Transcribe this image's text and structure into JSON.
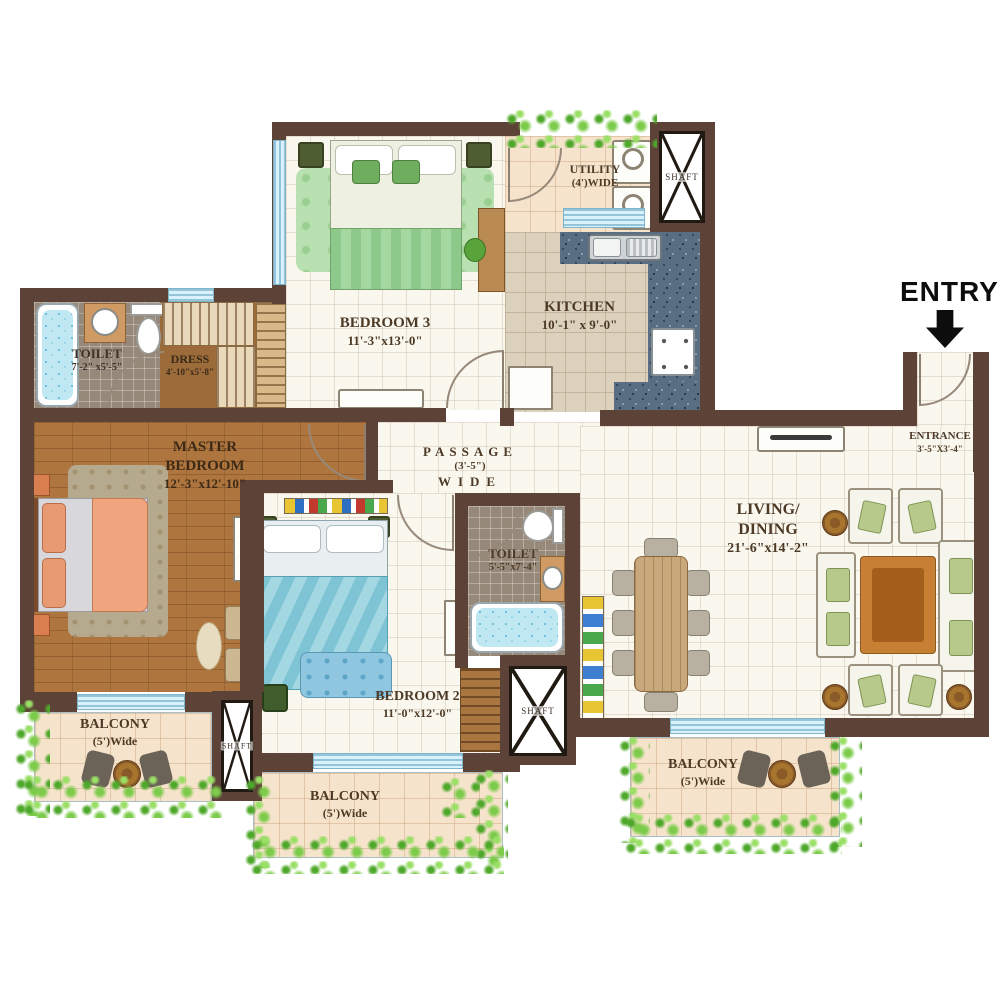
{
  "entry": {
    "label": "ENTRY"
  },
  "rooms": {
    "bedroom3": {
      "name": "BEDROOM 3",
      "dims": "11'-3\"x13'-0\""
    },
    "utility": {
      "name": "UTILITY",
      "dims": "(4')WIDE"
    },
    "kitchen": {
      "name": "KITCHEN",
      "dims": "10'-1\" x 9'-0\""
    },
    "toilet1": {
      "name": "TOILET",
      "dims": "7'-2\" x5'-5\""
    },
    "dress": {
      "name": "DRESS",
      "dims": "4'-10\"x5'-8\""
    },
    "master_bedroom": {
      "line1": "MASTER",
      "line2": "BEDROOM",
      "dims": "12'-3\"x12'-10\""
    },
    "passage": {
      "name": "PASSAGE",
      "dims": "(3'-5\")",
      "sub": "WIDE"
    },
    "toilet2": {
      "name": "TOILET",
      "dims": "5'-5\"x7'-4\""
    },
    "bedroom2": {
      "name": "BEDROOM 2",
      "dims": "11'-0\"x12'-0\""
    },
    "living_dining": {
      "line1": "LIVING/",
      "line2": "DINING",
      "dims": "21'-6\"x14'-2\""
    },
    "entrance": {
      "name": "ENTRANCE",
      "dims": "3'-5\"X3'-4\""
    },
    "shaft_top": {
      "name": "SHAFT"
    },
    "shaft_left": {
      "name": "SHAFT"
    },
    "shaft_mid": {
      "name": "SHAFT"
    },
    "balcony_left": {
      "name": "BALCONY",
      "dims": "(5')Wide"
    },
    "balcony_mid": {
      "name": "BALCONY",
      "dims": "(5')Wide"
    },
    "balcony_right": {
      "name": "BALCONY",
      "dims": "(5')Wide"
    }
  },
  "colors": {
    "wall": "#5d4337",
    "greenery": "#7ccb4a",
    "window_blue": "#d9f1fa",
    "wood_floor": "#ae753e",
    "granite": "#5a6e83"
  }
}
